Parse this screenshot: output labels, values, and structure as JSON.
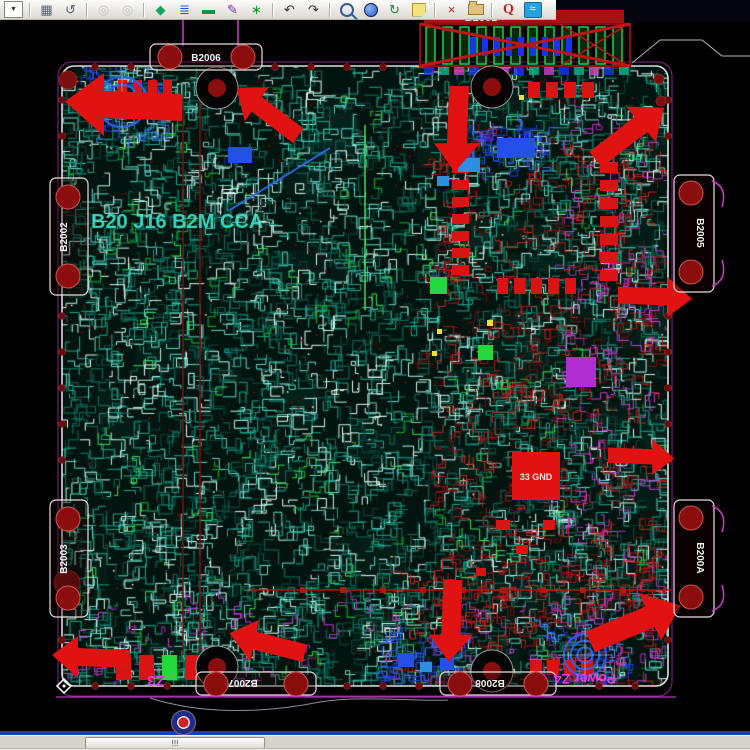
{
  "toolbar": {
    "icons": [
      {
        "name": "layer-list-dropdown",
        "type": "dropdown",
        "glyph": "▼"
      },
      {
        "name": "separator",
        "type": "sep"
      },
      {
        "name": "sheet-icon",
        "type": "glyph",
        "glyph": "▦",
        "color": "#55617a"
      },
      {
        "name": "rotate-icon",
        "type": "glyph",
        "glyph": "↺",
        "color": "#55617a"
      },
      {
        "name": "separator",
        "type": "sep"
      },
      {
        "name": "camera-icon",
        "type": "glyph",
        "glyph": "◎",
        "color": "#9a9a94",
        "disabled": true
      },
      {
        "name": "camera2-icon",
        "type": "glyph",
        "glyph": "◎",
        "color": "#9a9a94",
        "disabled": true
      },
      {
        "name": "separator",
        "type": "sep"
      },
      {
        "name": "shapes-icon",
        "type": "glyph",
        "glyph": "◆",
        "color": "#17a35c"
      },
      {
        "name": "layers-icon",
        "type": "glyph",
        "glyph": "≣",
        "color": "#2b4fd8"
      },
      {
        "name": "board-icon",
        "type": "glyph",
        "glyph": "▬",
        "color": "#0c9440"
      },
      {
        "name": "pen-icon",
        "type": "glyph",
        "glyph": "✎",
        "color": "#7a2fb8"
      },
      {
        "name": "component-icon",
        "type": "glyph",
        "glyph": "∗",
        "color": "#169a2e"
      },
      {
        "name": "separator",
        "type": "sep"
      },
      {
        "name": "undo-icon",
        "type": "glyph",
        "glyph": "↶",
        "color": "#333333"
      },
      {
        "name": "redo-icon",
        "type": "glyph",
        "glyph": "↷",
        "color": "#333333"
      },
      {
        "name": "separator",
        "type": "sep"
      },
      {
        "name": "zoom-icon",
        "type": "magnifier",
        "color": "#335a9a"
      },
      {
        "name": "globe-icon",
        "type": "circle"
      },
      {
        "name": "refresh-icon",
        "type": "glyph",
        "glyph": "↻",
        "color": "#0c8f3f"
      },
      {
        "name": "note-icon",
        "type": "note"
      },
      {
        "name": "separator",
        "type": "sep"
      },
      {
        "name": "delete-doc-icon",
        "type": "glyph",
        "glyph": "×",
        "color": "#c02020"
      },
      {
        "name": "folder-icon",
        "type": "folder"
      },
      {
        "name": "separator",
        "type": "sep"
      },
      {
        "name": "query-icon",
        "type": "letter",
        "glyph": "Q",
        "color": "#c02020"
      },
      {
        "name": "waveform-icon",
        "type": "wavebtn",
        "glyph": "≈"
      }
    ]
  },
  "view": {
    "colors": {
      "board_fill": "#02140f",
      "outline_white": "#dedede",
      "outline_magenta": "#a92fa9",
      "component_red": "#d81414",
      "arrow_red": "#e01212",
      "magenta": "#cf3bcf",
      "label_white": "#f0f0f0",
      "coil_blue": "#2e62e8",
      "pad_dark_red": "#7a0f0f",
      "green_part": "#22d83a",
      "blue_part": "#2450e8",
      "trace_teal": "#1ea78c"
    },
    "labels": [
      {
        "id": "connector-b2001-label",
        "text": "B2001",
        "x": 481,
        "y": 21,
        "color": "#f5f5f5",
        "size": 11,
        "rot": 0
      },
      {
        "id": "region-z3-label",
        "text": "Z3",
        "x": 156,
        "y": 676,
        "color": "#e23ee2",
        "size": 15,
        "rot": 180
      },
      {
        "id": "region-z4-label",
        "text": "Power Z4",
        "x": 585,
        "y": 674,
        "color": "#e23ee2",
        "size": 14,
        "rot": 180
      },
      {
        "id": "gnd-pad-label",
        "text": "33 GND",
        "x": 536,
        "y": 480,
        "color": "#ffe2da",
        "size": 9,
        "rot": 0
      },
      {
        "id": "silkscreen-text",
        "text": "B20 J16 B2M CCA",
        "x": 91,
        "y": 228,
        "color": "#38e8cc",
        "size": 20,
        "rot": 0,
        "anchor": "start",
        "opacity": 0.88
      }
    ],
    "edge_connectors": [
      {
        "label": "B2002",
        "side": "left",
        "x": 50,
        "y": 178,
        "w": 38,
        "h": 117,
        "pads": [
          [
            68,
            197
          ],
          [
            68,
            276
          ]
        ],
        "lx": 67,
        "ly": 237
      },
      {
        "label": "B2003",
        "side": "left",
        "x": 50,
        "y": 500,
        "w": 38,
        "h": 117,
        "pads": [
          [
            68,
            519
          ],
          [
            68,
            598
          ]
        ],
        "lx": 67,
        "ly": 559
      },
      {
        "label": "B2005",
        "side": "right",
        "x": 674,
        "y": 175,
        "w": 40,
        "h": 117,
        "pads": [
          [
            691,
            193
          ],
          [
            691,
            272
          ]
        ],
        "lx": 697,
        "ly": 233
      },
      {
        "label": "B200A",
        "side": "right",
        "x": 674,
        "y": 500,
        "w": 40,
        "h": 117,
        "pads": [
          [
            691,
            518
          ],
          [
            691,
            597
          ]
        ],
        "lx": 697,
        "ly": 558
      },
      {
        "label": "B2006",
        "side": "top",
        "x": 150,
        "y": 44,
        "w": 112,
        "h": 26,
        "pads": [
          [
            170,
            57
          ],
          [
            243,
            57
          ]
        ],
        "lx": 206,
        "ly": 61
      },
      {
        "label": "B2007",
        "side": "bottom",
        "x": 196,
        "y": 672,
        "w": 120,
        "h": 23,
        "pads": [
          [
            216,
            684
          ],
          [
            296,
            684
          ]
        ],
        "lx": 243,
        "ly": 680
      },
      {
        "label": "B2008",
        "side": "bottom",
        "x": 440,
        "y": 672,
        "w": 116,
        "h": 23,
        "pads": [
          [
            460,
            684
          ],
          [
            536,
            684
          ]
        ],
        "lx": 490,
        "ly": 680
      }
    ],
    "arrows": [
      {
        "x": 122,
        "y": 106,
        "r": 0,
        "s": 1.5
      },
      {
        "x": 266,
        "y": 112,
        "r": 35,
        "s": 1.0
      },
      {
        "x": 458,
        "y": 130,
        "r": -90,
        "s": 1.1
      },
      {
        "x": 630,
        "y": 132,
        "r": 140,
        "s": 1.1
      },
      {
        "x": 656,
        "y": 296,
        "r": 180,
        "s": 0.95
      },
      {
        "x": 642,
        "y": 456,
        "r": 180,
        "s": 0.85
      },
      {
        "x": 636,
        "y": 622,
        "r": 155,
        "s": 1.25
      },
      {
        "x": 452,
        "y": 622,
        "r": -90,
        "s": 1.05
      },
      {
        "x": 266,
        "y": 644,
        "r": 12,
        "s": 1.0
      },
      {
        "x": 90,
        "y": 658,
        "r": 0,
        "s": 1.0
      }
    ],
    "mount_holes": [
      [
        217,
        88
      ],
      [
        492,
        87
      ],
      [
        217,
        667
      ],
      [
        492,
        671
      ]
    ],
    "corner_pads": [
      [
        68,
        80,
        9
      ],
      [
        67,
        583,
        13
      ],
      [
        659,
        79,
        5
      ],
      [
        661,
        101,
        5
      ]
    ],
    "coils": [
      {
        "x": 122,
        "y": 102,
        "r": 25
      },
      {
        "x": 585,
        "y": 655,
        "r": 21
      }
    ],
    "component_groups": [
      {
        "name": "resistor-bank-left",
        "x": 452,
        "y": 146,
        "dx": 0,
        "dy": 17,
        "n": 8,
        "w": 17,
        "h": 10
      },
      {
        "name": "resistor-bank-right",
        "x": 600,
        "y": 144,
        "dx": 0,
        "dy": 18,
        "n": 8,
        "w": 18,
        "h": 11
      },
      {
        "name": "resistor-row-bottom",
        "x": 497,
        "y": 278,
        "dx": 17,
        "dy": 0,
        "n": 5,
        "w": 11,
        "h": 16
      },
      {
        "name": "resistor-row-top",
        "x": 528,
        "y": 82,
        "dx": 18,
        "dy": 0,
        "n": 4,
        "w": 12,
        "h": 16
      },
      {
        "name": "pad-row-bottom-edge",
        "x": 530,
        "y": 660,
        "dx": 17,
        "dy": 0,
        "n": 4,
        "w": 12,
        "h": 15
      },
      {
        "name": "arrow-tail-bars",
        "x": 118,
        "y": 80,
        "dx": 15,
        "dy": 0,
        "n": 4,
        "w": 9,
        "h": 17
      }
    ],
    "misc_rects": [
      {
        "x": 116,
        "y": 655,
        "w": 15,
        "h": 25,
        "c": "#d81414"
      },
      {
        "x": 139,
        "y": 655,
        "w": 15,
        "h": 25,
        "c": "#d81414"
      },
      {
        "x": 162,
        "y": 655,
        "w": 15,
        "h": 25,
        "c": "#22d83a"
      },
      {
        "x": 185,
        "y": 655,
        "w": 15,
        "h": 25,
        "c": "#d81414"
      },
      {
        "x": 430,
        "y": 277,
        "w": 17,
        "h": 17,
        "c": "#22d83a"
      },
      {
        "x": 478,
        "y": 345,
        "w": 15,
        "h": 15,
        "c": "#22d83a"
      },
      {
        "x": 566,
        "y": 357,
        "w": 30,
        "h": 30,
        "c": "#b02fd0"
      },
      {
        "x": 458,
        "y": 158,
        "w": 22,
        "h": 14,
        "c": "#2e8fe0"
      },
      {
        "x": 437,
        "y": 176,
        "w": 12,
        "h": 10,
        "c": "#2e8fe0"
      },
      {
        "x": 497,
        "y": 138,
        "w": 38,
        "h": 20,
        "c": "#2450e8"
      },
      {
        "x": 228,
        "y": 147,
        "w": 24,
        "h": 16,
        "c": "#2450e8"
      },
      {
        "x": 398,
        "y": 653,
        "w": 16,
        "h": 14,
        "c": "#2450e8"
      },
      {
        "x": 420,
        "y": 662,
        "w": 12,
        "h": 10,
        "c": "#2e8fe0"
      },
      {
        "x": 440,
        "y": 658,
        "w": 14,
        "h": 12,
        "c": "#2450e8"
      },
      {
        "x": 512,
        "y": 452,
        "w": 48,
        "h": 48,
        "c": "#e01212"
      },
      {
        "x": 496,
        "y": 520,
        "w": 14,
        "h": 10,
        "c": "#d81414"
      },
      {
        "x": 516,
        "y": 545,
        "w": 12,
        "h": 9,
        "c": "#d81414"
      },
      {
        "x": 476,
        "y": 568,
        "w": 10,
        "h": 8,
        "c": "#d81414"
      },
      {
        "x": 543,
        "y": 520,
        "w": 12,
        "h": 10,
        "c": "#d81414"
      },
      {
        "x": 487,
        "y": 320,
        "w": 6,
        "h": 6,
        "c": "#f0e030"
      },
      {
        "x": 437,
        "y": 329,
        "w": 5,
        "h": 5,
        "c": "#f0e030"
      },
      {
        "x": 432,
        "y": 351,
        "w": 5,
        "h": 5,
        "c": "#f0e030"
      },
      {
        "x": 519,
        "y": 95,
        "w": 5,
        "h": 5,
        "c": "#f0e030"
      }
    ]
  },
  "statusbar": {
    "value": "!!!"
  }
}
